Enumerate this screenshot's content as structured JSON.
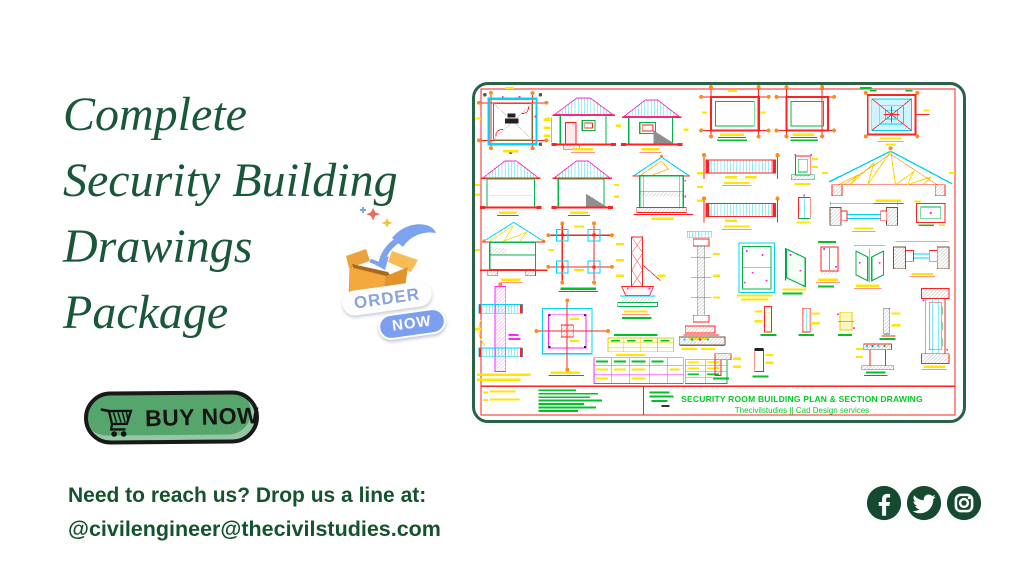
{
  "headline": {
    "lines": [
      "Complete",
      "Security Building",
      "Drawings",
      "Package"
    ]
  },
  "sticker": {
    "order": "ORDER",
    "now": "NOW"
  },
  "buy_button": {
    "label": "BUY NOW"
  },
  "contact": {
    "prompt": "Need to reach us? Drop us a line at:",
    "email": "@civilengineer@thecivilstudies.com"
  },
  "social": {
    "icons": [
      "facebook-icon",
      "twitter-icon",
      "instagram-icon"
    ]
  },
  "cad_sheet": {
    "title": "SECURITY ROOM BUILDING PLAN & SECTION DRAWING",
    "subtitle": "Thecivilstudies || Cad Design services"
  },
  "colors": {
    "headline_green": "#1a573a",
    "contact_green": "#14532d",
    "button_green": "#55a56c",
    "social_green": "#164a30",
    "sheet_border_green": "#2a6149",
    "sheet_title_green": "#00cc22",
    "cad_red": "#ff2222",
    "cad_green": "#00b44a",
    "cad_cyan": "#00d4f5",
    "cad_yellow": "#ffe600",
    "cad_magenta": "#ff22ff",
    "cad_orange": "#ff8c1a"
  }
}
